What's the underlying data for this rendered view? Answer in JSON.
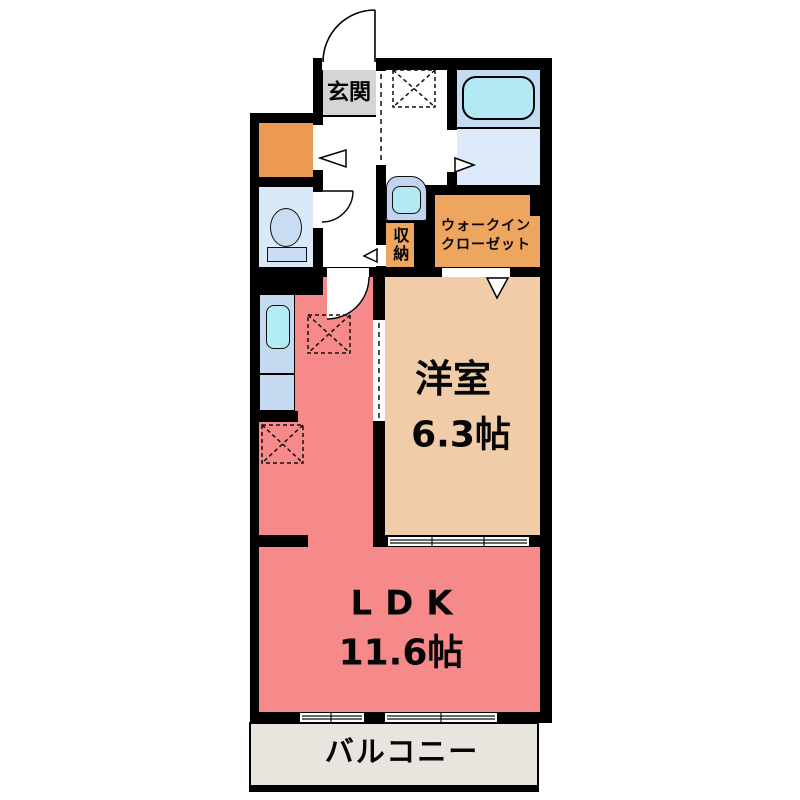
{
  "plan": {
    "rooms": {
      "genkan": {
        "label": "玄関"
      },
      "wic": {
        "line1": "ウォークイン",
        "line2": "クローゼット"
      },
      "shuno": {
        "label": "収納"
      },
      "bedroom": {
        "label": "洋室",
        "size": "6.3帖"
      },
      "ldk": {
        "label": "LDK",
        "size": "11.6帖"
      },
      "balcony": {
        "label": "バルコニー"
      }
    },
    "icons": [
      "bathtub-icon",
      "toilet-icon",
      "washbasin-icon",
      "kitchen-sink-icon",
      "washer-space-dashed-box-icon",
      "fridge-space-dashed-box-icon",
      "appliance-space-dashed-box-icon",
      "entrance-door-swing-arc-icon",
      "toilet-door-swing-arc-icon",
      "ldk-door-swing-arc-icon",
      "door-direction-triangle-icon",
      "sliding-door-icon",
      "sliding-window-icon"
    ],
    "colors": {
      "wall": "#000000",
      "ldk_fill": "#F68A8A",
      "bedroom_fill": "#F0CDA8",
      "closet_fill": "#EDA55F",
      "entry_closet_fill": "#EC9A51",
      "genkan_fill": "#D5D5D5",
      "balcony_fill": "#E7E5DE",
      "bath_tub_zone_fill": "#C3DCF2",
      "bath_floor_fill": "#DCEAF9",
      "tub_fill": "#B2E9F4",
      "toilet_room_fill": "#DAE9F8",
      "fixture_fill": "#C8DCF4",
      "counter_fill": "#C5D9F0"
    }
  }
}
